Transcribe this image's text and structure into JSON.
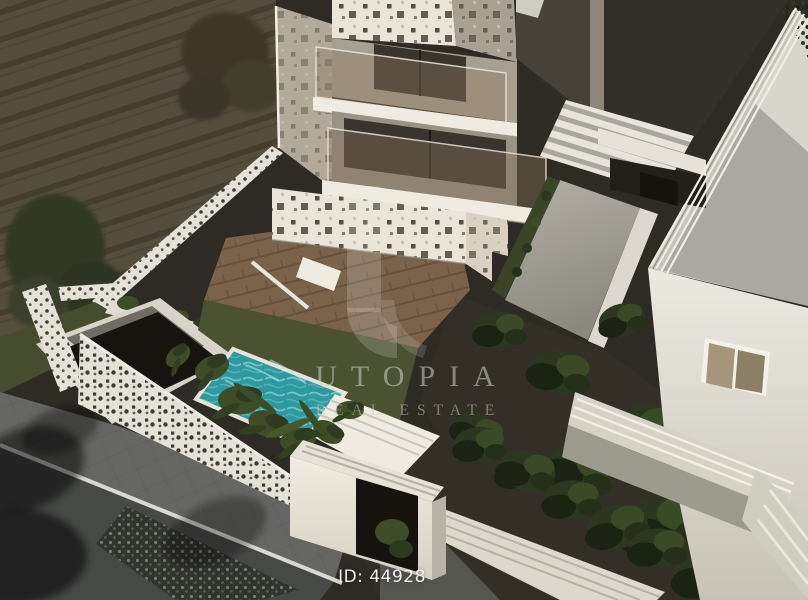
{
  "image": {
    "type": "3d-architectural-rendering",
    "description": "Aerial dusk render: modern white apartment building with perforated facade, glass balconies, courtyard wood deck, turquoise plunge pool behind perforated garden walls, tiled sidewalk, neighbouring white building with cornice mouldings"
  },
  "watermark": {
    "brand_line1": "UTOPIA",
    "brand_line2": "REAL ESTATE",
    "logo": "utopia-u-mark"
  },
  "listing": {
    "id_label": "ID: 44928"
  },
  "colors": {
    "soil": "#564e3d",
    "soil_furrow": "#453e2f",
    "tree_foliage": "#3c3729",
    "tree_foliage_dark": "#313827",
    "grass": "#464d2f",
    "grass_bright": "#4a5232",
    "facade_white": "#eae5d8",
    "facade_cream": "#d9d2c2",
    "facade_side": "#b2a999",
    "facade_side2": "#a8a092",
    "hole_dark": "#554f3f",
    "perforation": "#3f3b30",
    "glass_dark": "#39342c",
    "glass_tint": "rgba(139,120,96,0.40)",
    "slab_white": "#efebe0",
    "fence_white": "#e4e1d7",
    "pool_water": "#2e99a0",
    "pool_ripple": "#8fd8d2",
    "wood_deck": "#7a624b",
    "wood_gap": "#67513d",
    "pavement": "#666764",
    "pavement_line": "#57585a",
    "asphalt": "#474947",
    "curb": "#dad8d0",
    "dark_building": "#332f29",
    "dark_building_light": "#474338",
    "stairs_light": "#e8e4da",
    "stairs_gray": "#a9a69c",
    "path": "#a5a196",
    "roof_light": "#d8d5cb",
    "roof_shadow": "#a2a099",
    "right_facade": "#e9e6dd",
    "parapet": "#d6d2c6",
    "wall_shaded": "#9d9a8e",
    "window_pane_left": "#a5967b",
    "window_pane_right": "#8d7f66",
    "garden_soil": "#332f26",
    "bush": "#2c371f",
    "bush_light": "#3d4d28",
    "bush_dark": "#1b2413",
    "door_dark": "#16130e",
    "plant": "#3e4d28",
    "watermark": "rgba(210,210,205,0.55)",
    "id_text": "rgba(255,255,255,0.92)"
  }
}
